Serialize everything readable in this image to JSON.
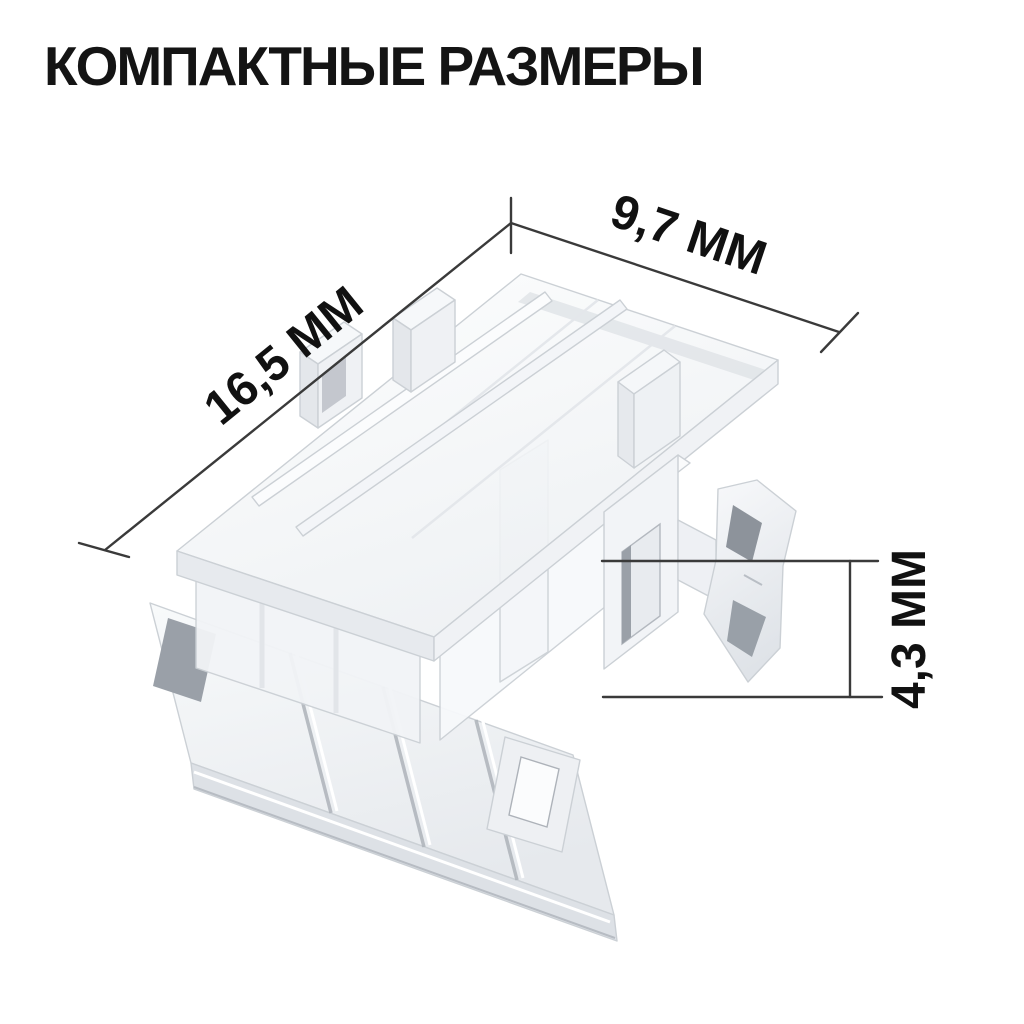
{
  "title": "КОМПАКТНЫЕ РАЗМЕРЫ",
  "illustration": {
    "subject": "transparent-led-strip-connector-3d-render"
  },
  "dimensions": {
    "length_label": "16,5 ММ",
    "width_label": "9,7 ММ",
    "height_label": "4,3 ММ"
  },
  "colors": {
    "background": "#ffffff",
    "title_text": "#141414",
    "dimension_lines": "#3a3a3a",
    "dimension_text": "#111111",
    "plastic_light": "#f7f9fb",
    "plastic_mid": "#e8ebef",
    "plastic_shadow": "#9aa0a8"
  }
}
